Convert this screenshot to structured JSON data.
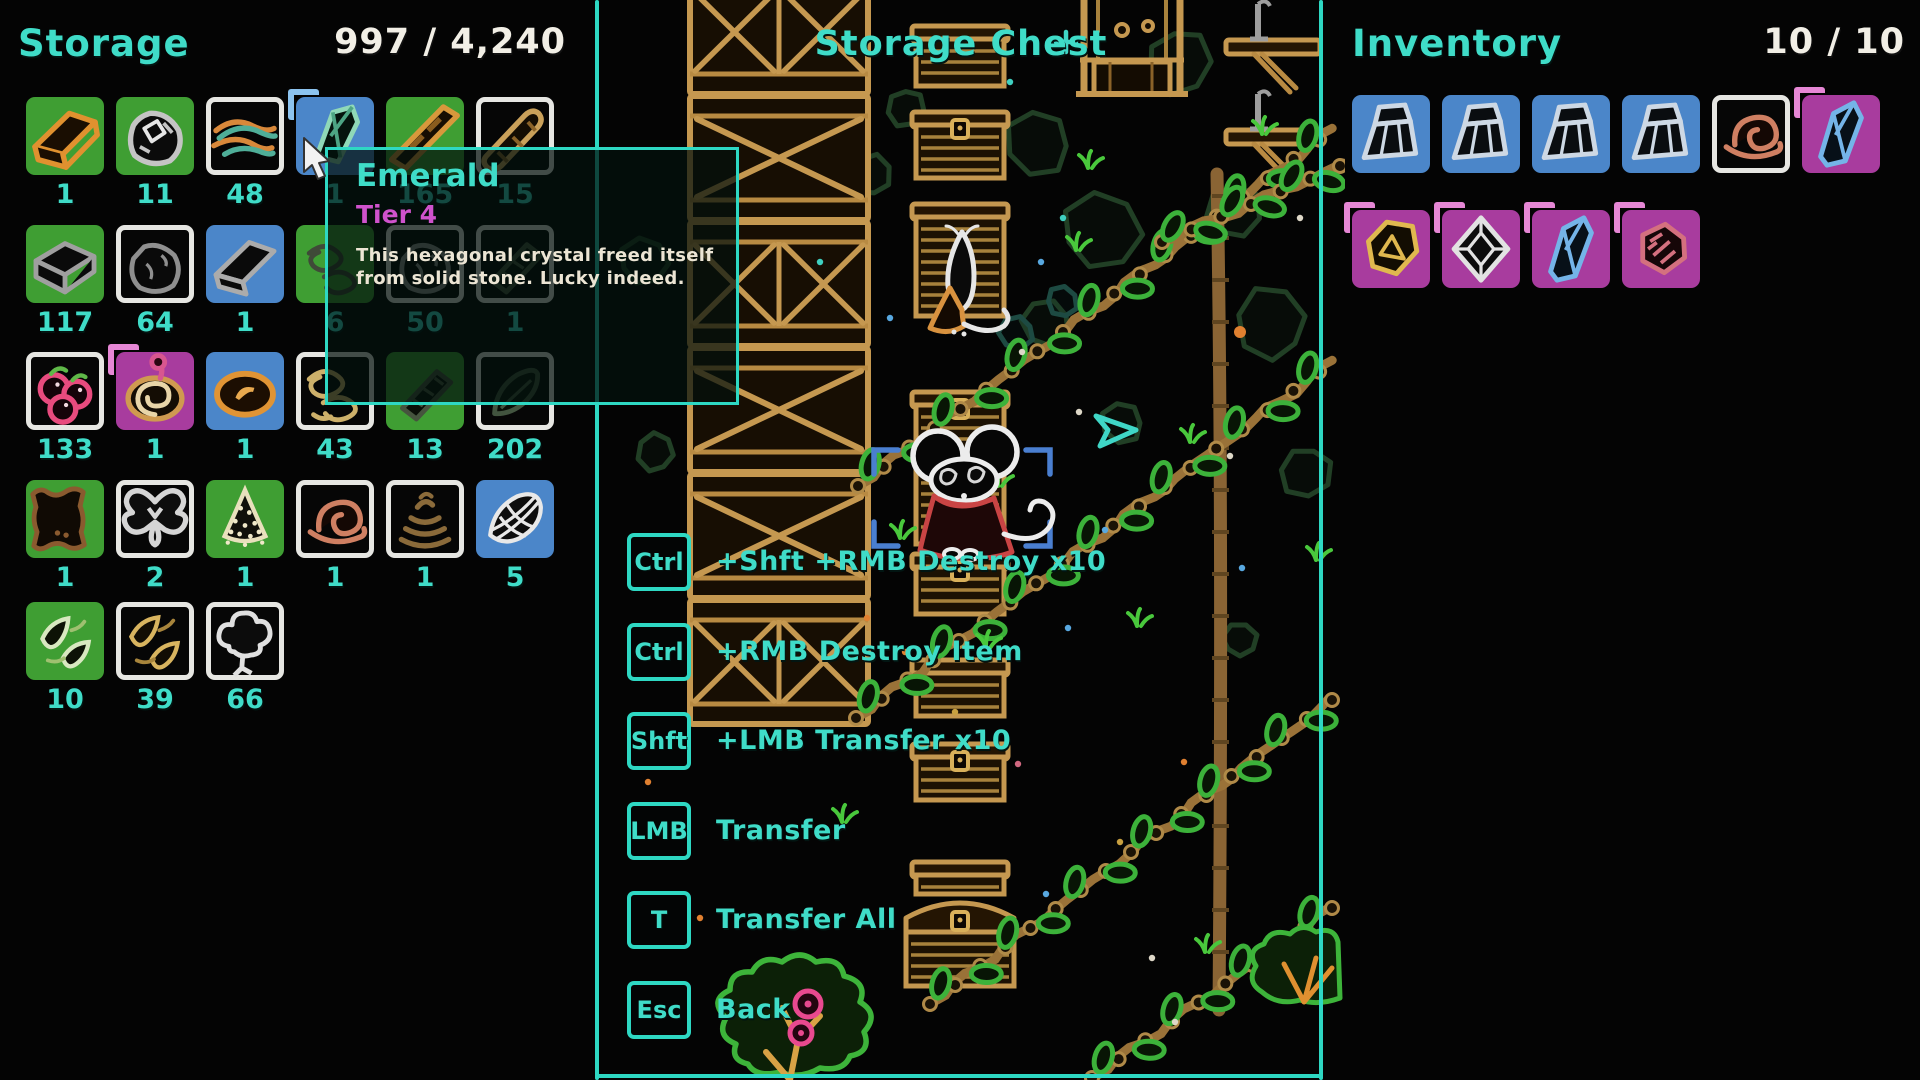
{
  "colors": {
    "teal_ui": "#2ed8c3",
    "teal_text": "#3fdcc8",
    "white_text": "#f2efe6",
    "tier_magenta": "#cf52cc",
    "slot_green": "#3f9e33",
    "slot_blue": "#4b86c9",
    "slot_magenta": "#a83c9e",
    "slot_white_border": "#e6e6e2",
    "bracket_blue": "#8cc3ef",
    "bracket_pink": "#e687d5",
    "world_bracket_blue": "#4a7fd0"
  },
  "storage": {
    "title": "Storage",
    "count": "997 / 4,240",
    "rows": [
      [
        {
          "icon": "ingot-orange",
          "slot": "green",
          "count": "1"
        },
        {
          "icon": "ore-chunk",
          "slot": "green",
          "count": "11"
        },
        {
          "icon": "fiber-bundle",
          "slot": "white",
          "count": "48"
        },
        {
          "icon": "emerald-crystal",
          "slot": "blue",
          "count": "1",
          "bracket": "blue"
        },
        {
          "icon": "wood-beam",
          "slot": "green",
          "count": "165"
        },
        {
          "icon": "wood-log",
          "slot": "white",
          "count": "15"
        }
      ],
      [
        {
          "icon": "dark-brick",
          "slot": "green",
          "count": "117"
        },
        {
          "icon": "dark-rock",
          "slot": "white",
          "count": "64"
        },
        {
          "icon": "dark-ingot",
          "slot": "blue",
          "count": "1"
        },
        {
          "icon": "dark-tangle",
          "slot": "green",
          "count": "6"
        },
        {
          "icon": "dark-rock",
          "slot": "white",
          "count": "50"
        },
        {
          "icon": "dark-plank",
          "slot": "white",
          "count": "1"
        }
      ],
      [
        {
          "icon": "berries",
          "slot": "white",
          "count": "133"
        },
        {
          "icon": "onion-swirl",
          "slot": "magenta",
          "count": "1",
          "bracket": "pink"
        },
        {
          "icon": "mushroom-cap",
          "slot": "blue",
          "count": "1"
        },
        {
          "icon": "tan-tangle",
          "slot": "white",
          "count": "43"
        },
        {
          "icon": "dark-plank",
          "slot": "green",
          "count": "13"
        },
        {
          "icon": "dark-leaf",
          "slot": "white",
          "count": "202"
        }
      ],
      [
        {
          "icon": "brown-pelt",
          "slot": "green",
          "count": "1"
        },
        {
          "icon": "moth",
          "slot": "white",
          "count": "2"
        },
        {
          "icon": "seed-cone",
          "slot": "green",
          "count": "1"
        },
        {
          "icon": "snail-shell",
          "slot": "white",
          "count": "1"
        },
        {
          "icon": "dung-coil",
          "slot": "white",
          "count": "1"
        },
        {
          "icon": "striped-shell",
          "slot": "blue",
          "count": "5"
        }
      ],
      [
        {
          "icon": "pale-leaves",
          "slot": "green",
          "count": "10"
        },
        {
          "icon": "gold-leaves",
          "slot": "white",
          "count": "39"
        },
        {
          "icon": "white-tree",
          "slot": "white",
          "count": "66"
        }
      ]
    ]
  },
  "tooltip": {
    "title": "Emerald",
    "tier": "Tier 4",
    "desc_line1": "This hexagonal crystal freed itself",
    "desc_line2": "from solid stone. Lucky indeed."
  },
  "middle": {
    "title": "Storage Chest",
    "keybinds": [
      {
        "key": "Ctrl",
        "label": "+Shft +RMB Destroy x10"
      },
      {
        "key": "Ctrl",
        "label": "+RMB Destroy Item"
      },
      {
        "key": "Shft",
        "label": "+LMB Transfer x10"
      },
      {
        "key": "LMB",
        "label": "Transfer"
      },
      {
        "key": "T",
        "label": "Transfer All"
      },
      {
        "key": "Esc",
        "label": "Back"
      }
    ]
  },
  "inventory": {
    "title": "Inventory",
    "count": "10 / 10",
    "rows": [
      [
        {
          "icon": "rock-chunk",
          "slot": "blue"
        },
        {
          "icon": "rock-chunk",
          "slot": "blue"
        },
        {
          "icon": "rock-chunk",
          "slot": "blue"
        },
        {
          "icon": "rock-chunk",
          "slot": "blue"
        },
        {
          "icon": "snail-shell",
          "slot": "white"
        },
        {
          "icon": "gem-blue",
          "slot": "magenta",
          "bracket": "pink"
        }
      ],
      [
        {
          "icon": "gem-gold",
          "slot": "magenta",
          "bracket": "pink"
        },
        {
          "icon": "gem-octahedron",
          "slot": "magenta",
          "bracket": "pink"
        },
        {
          "icon": "gem-blue",
          "slot": "magenta",
          "bracket": "pink"
        },
        {
          "icon": "gem-rose",
          "slot": "magenta",
          "bracket": "pink"
        }
      ]
    ]
  },
  "world": {
    "vines": [
      [
        858,
        486,
        1332,
        130,
        13
      ],
      [
        856,
        718,
        1332,
        362,
        13
      ],
      [
        930,
        1004,
        1332,
        700,
        12
      ],
      [
        1092,
        1078,
        1332,
        908,
        7
      ],
      [
        1162,
        242,
        1340,
        166,
        6
      ]
    ],
    "grass": [
      [
        1088,
        168
      ],
      [
        998,
        486
      ],
      [
        1190,
        442
      ],
      [
        1137,
        626
      ],
      [
        986,
        648
      ],
      [
        842,
        822
      ],
      [
        1205,
        952
      ],
      [
        1262,
        134
      ],
      [
        900,
        538
      ],
      [
        1316,
        560
      ],
      [
        1076,
        250
      ]
    ],
    "dots": [
      [
        1063,
        218,
        "t"
      ],
      [
        1041,
        262,
        "b"
      ],
      [
        1079,
        412,
        "w"
      ],
      [
        1022,
        352,
        "w"
      ],
      [
        1046,
        894,
        "b"
      ],
      [
        1068,
        628,
        "b"
      ],
      [
        1240,
        332,
        "o",
        6
      ],
      [
        1184,
        762,
        "o"
      ],
      [
        1018,
        764,
        "p"
      ],
      [
        905,
        652,
        "o"
      ],
      [
        955,
        712,
        "y"
      ],
      [
        867,
        618,
        "o"
      ],
      [
        1105,
        530,
        "b"
      ],
      [
        1152,
        958,
        "w"
      ],
      [
        1242,
        568,
        "b"
      ],
      [
        1120,
        842,
        "y"
      ],
      [
        1175,
        1022,
        "w"
      ],
      [
        820,
        262,
        "t"
      ],
      [
        648,
        782,
        "o"
      ],
      [
        1300,
        218,
        "w"
      ],
      [
        890,
        318,
        "b"
      ],
      [
        1230,
        456,
        "w"
      ],
      [
        700,
        918,
        "o"
      ],
      [
        1010,
        82,
        "t"
      ]
    ],
    "cave": [
      [
        830,
        95,
        0.9,
        10,
        0
      ],
      [
        872,
        175,
        0.6,
        120,
        0
      ],
      [
        1038,
        142,
        0.95,
        45,
        0
      ],
      [
        1102,
        232,
        1.15,
        200,
        0
      ],
      [
        1178,
        62,
        0.95,
        300,
        0
      ],
      [
        1235,
        212,
        0.8,
        160,
        0
      ],
      [
        1272,
        322,
        1.05,
        80,
        0
      ],
      [
        1046,
        322,
        0.7,
        20,
        0
      ],
      [
        986,
        242,
        0.5,
        260,
        0
      ],
      [
        1305,
        472,
        0.75,
        330,
        0
      ],
      [
        644,
        262,
        0.7,
        200,
        0
      ],
      [
        656,
        452,
        0.55,
        100,
        0
      ],
      [
        1122,
        422,
        0.6,
        40,
        0
      ],
      [
        760,
        150,
        0.5,
        70,
        0
      ],
      [
        1240,
        640,
        0.5,
        180,
        0
      ],
      [
        905,
        108,
        0.55,
        310,
        0
      ],
      [
        1016,
        332,
        0.5,
        15,
        1
      ],
      [
        1062,
        302,
        0.45,
        220,
        1
      ]
    ]
  }
}
